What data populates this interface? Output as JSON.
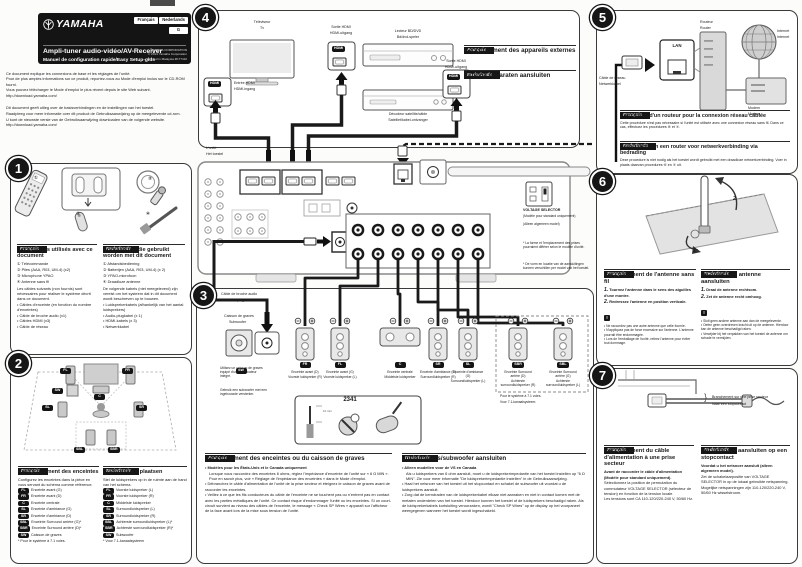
{
  "header": {
    "brand": "YAMAHA",
    "lang_fr": "Français",
    "lang_nl": "Nederlands",
    "g_label": "G",
    "title": "Ampli-tuner audio-vidéo/AV-Receiver",
    "subtitle": "Manuel de configuration rapide/Easy Setup-gids",
    "corp": "YAMAHA CORPORATION",
    "copyright": "© 2014 Yamaha Corporation",
    "printed": "Printed in Malaysia  ZK77110"
  },
  "intro": {
    "fr1": "Ce document explique les connexions de base et les réglages de l'unité.",
    "fr2": "Pour de plus amples informations sur ce produit, reportez-vous au Mode d'emploi inclus sur le CD-ROM fourni.",
    "fr3": "Vous pouvez télécharger le Mode d'emploi le plus récent depuis le site Web suivant.",
    "fr4": "http://download.yamaha.com/",
    "nl1": "Dit document geeft uitleg over de basisverbindingen en de instellingen van het toestel.",
    "nl2": "Raadpleeg voor meer informatie over dit product de Gebruiksaanwijzing op de meegeleverde cd-rom.",
    "nl3": "U kunt de nieuwste versie van de Gebruiksaanwijzing downloaden van de volgende website.",
    "nl4": "http://download.yamaha.com/"
  },
  "tag_fr": "Français",
  "tag_nl": "Nederlands",
  "step1": {
    "num": "1",
    "marks": [
      "①",
      "②",
      "③",
      "④"
    ],
    "fr": {
      "title": "Accessoires utilisés avec ce document",
      "items": [
        "① Télécommande",
        "② Piles (AAA, R03, UM-4) (x2)",
        "③ Microphone YPAO",
        "④ Antenne sans fil"
      ],
      "note": "Les câbles suivants (non fournis) sont nécessaires pour réaliser le système décrit dans ce document.",
      "bullets": [
        "• Câbles d'enceinte (en fonction du nombre d'enceintes)",
        "• Câble de broche audio (x1)",
        "• Câbles HDMI (x3)",
        "• Câble de réseau"
      ]
    },
    "nl": {
      "title": "Accessoires die gebruikt worden met dit document",
      "items": [
        "① Afstandsbediening",
        "② Batterijen (AAA, R03, UM-4) (x 2)",
        "③ YPAO-microfoon",
        "④ Draadloze antenne"
      ],
      "note": "De volgende kabels (niet meegeleverd) zijn vereist om het systeem dat in dit document wordt beschreven op te bouwen.",
      "bullets": [
        "• Luidsprekerkabels (afhankelijk van het aantal luidsprekers)",
        "• Audio-plugkabel (x 1)",
        "• HDMI-kabels (x 3)",
        "• Netwerkkabel"
      ]
    }
  },
  "step2": {
    "num": "2",
    "diagram": {
      "fl": "FL",
      "fr": "FR",
      "c": "C",
      "sw": "SW",
      "sl": "SL",
      "sr": "SR",
      "sbl": "SBL",
      "sbr": "SBR"
    },
    "fr": {
      "title": "Positionnement des enceintes",
      "intro": "Configurez les enceintes dans la pièce en vous servant du schéma comme référence.",
      "rows": [
        {
          "b": "FL",
          "t": "Enceinte avant (G)"
        },
        {
          "b": "FR",
          "t": "Enceinte avant (D)"
        },
        {
          "b": "C",
          "t": "Enceinte centrale"
        },
        {
          "b": "SL",
          "t": "Enceinte d'ambiance (G)"
        },
        {
          "b": "SR",
          "t": "Enceinte d'ambiance (D)"
        },
        {
          "b": "SBL",
          "t": "Enceinte Surround arrière (G)*"
        },
        {
          "b": "SBR",
          "t": "Enceinte Surround arrière (D)*"
        },
        {
          "b": "SW",
          "t": "Caisson de graves"
        }
      ],
      "footnote": "* Pour le système à 7.1 voies."
    },
    "nl": {
      "title": "Luidsprekers plaatsen",
      "intro": "Stel de luidsprekers op in de ruimte aan de hand van het schema.",
      "rows": [
        {
          "b": "FL",
          "t": "Voorste luidspreker (L)"
        },
        {
          "b": "FR",
          "t": "Voorste luidspreker (R)"
        },
        {
          "b": "C",
          "t": "Middelste luidspreker"
        },
        {
          "b": "SL",
          "t": "Surroundluidspreker (L)"
        },
        {
          "b": "SR",
          "t": "Surroundluidspreker (R)"
        },
        {
          "b": "SBL",
          "t": "Achterste surroundluidspreker (L)*"
        },
        {
          "b": "SBR",
          "t": "Achterste surroundluidspreker (R)*"
        },
        {
          "b": "SW",
          "t": "Subwoofer"
        }
      ],
      "footnote": "* Voor 7.1-kanaalsysteem"
    }
  },
  "step3": {
    "num": "3",
    "pin_cable_fr": "Câble de broche audio",
    "pin_cable_nl": "Audio-plugkabel",
    "sw_title_fr": "Caisson de graves",
    "sw_title_nl": "Subwoofer",
    "sw_badge": "SW",
    "sw_note_fr": "Utilisez un caisson de graves équipé d'un amplificateur intégré.",
    "sw_note_nl": "Gebruik een subwoofer met een ingebouwde versterker.",
    "speakers": [
      {
        "b": "FR",
        "fr": "Enceinte avant (D)",
        "nl": "Voorste luidspreker (R)"
      },
      {
        "b": "FL",
        "fr": "Enceinte avant (G)",
        "nl": "Voorste luidspreker (L)"
      },
      {
        "b": "C",
        "fr": "Enceinte centrale",
        "nl": "Middelste luidspreker"
      },
      {
        "b": "SR",
        "fr": "Enceinte d'ambiance (D)",
        "nl": "Surroundluidspreker (R)"
      },
      {
        "b": "SL",
        "fr": "Enceinte d'ambiance (G)",
        "nl": "Surroundluidspreker (L)"
      },
      {
        "b": "SBR",
        "fr": "Enceinte Surround arrière (D)",
        "nl": "Achterste surroundluidspreker (R)"
      },
      {
        "b": "SBL",
        "fr": "Enceinte Surround arrière (G)",
        "nl": "Achterste surroundluidspreker (L)"
      }
    ],
    "note71_fr": "Pour le système à 7.1 voies.",
    "note71_nl": "Voor 7.1-kanaalsysteem",
    "inset_num": "2341",
    "inset_mm": "10 mm",
    "fr": {
      "title": "Raccordement des enceintes ou du caisson de graves",
      "b1_head": "• Modèles pour les États-Unis et le Canada uniquement",
      "b1": "Lorsque vous raccordez des enceintes 6 ohms, réglez l'impédance d'enceinte de l'unité sur « 6 Ω MIN ». Pour en savoir plus, voir « Réglage de l'impédance des enceintes » dans le Mode d'emploi.",
      "b2": "• Débranchez le câble d'alimentation de l'unité de la prise secteur et éteignez le caisson de graves avant de raccorder les enceintes.",
      "b3": "• Veillez à ce que les fils conducteurs du câble de l'enceinte ne se touchent pas ou n'entrent pas en contact avec les parties métalliques de l'unité. Ce contact risque d'endommager l'unité ou les enceintes. Si un court-circuit survient au niveau des câbles de l'enceinte, le message « Check SP Wires » apparaît sur l'afficheur de la face avant lors de la mise sous tension de l'unité."
    },
    "nl": {
      "title": "Luidsprekers/subwoofer aansluiten",
      "b1_head": "• Alleen modellen voor de VS en Canada",
      "b1": "Als u luidsprekers van 6 ohm aansluit, moet u de luidsprekerimpedantie van het toestel instellen op \"6 Ω MIN\". Zie voor meer informatie \"De luidsprekerimpedantie instellen\" in de Gebruiksaanwijzing.",
      "b2": "• Haal het netsnoer van het toestel uit het stopcontact en schakel de subwoofer uit voordat u de luidsprekers aansluit.",
      "b3": "• Zorg dat de kerndraden van de luidsprekerkabel elkaar niet aanraken en niet in contact komen met de metalen onderdelen van het toestel. Hierdoor kunnen het toestel of de luidsprekers beschadigd raken. Als de luidsprekerkabels kortsluiting veroorzaken, wordt \"Check SP Wires\" op de display op het voorpaneel weergegeven wanneer het toestel wordt ingeschakeld."
    }
  },
  "step4": {
    "num": "4",
    "tv_fr": "Téléviseur",
    "tv_nl": "Tv",
    "in_fr": "Entrée HDMI",
    "in_nl": "HDMI-ingang",
    "out_fr": "Sortie HDMI",
    "out_nl": "HDMI-uitgang",
    "bd_fr": "Lecteur BD/DVD",
    "bd_nl": "Bd/dvd-speler",
    "sat_fr": "Décodeur satellite/câble",
    "sat_nl": "Satelliet/kabel-ontvanger",
    "hdmi": "HDMI",
    "fr_title": "Raccordement des appareils externes",
    "nl_title": "Externe apparaten aansluiten"
  },
  "unit": {
    "label_fr": "L'unité",
    "label_nl": "Het toestel",
    "vs": "VOLTAGE SELECTOR",
    "vs_fr": "(Modèle pour standard uniquement)",
    "vs_nl": "(Alleen algemeen model)",
    "fn_fr": "* La forme et l'emplacement des prises pourraient différer selon le modèle d'unité.",
    "fn_nl": "* De vorm en locatie van de aansluitingen kunnen verschillen per model van het toestel."
  },
  "step5": {
    "num": "5",
    "router_fr": "Routeur",
    "router_nl": "Router",
    "inet_fr": "Internet",
    "inet_nl": "Internet",
    "lan": "LAN",
    "cable_fr": "Câble de réseau",
    "cable_nl": "Netwerkkabel",
    "modem_fr": "Modem",
    "modem_nl": "Modem",
    "fr_title": "Connexion d'un routeur pour la connexion réseau câblée",
    "fr_body": "Cette procédure n'est pas nécessaire si l'unité est utilisée avec une connexion réseau sans fil. Dans ce cas, effectuez les procédures ⑥ et ⑦.",
    "nl_title": "Aansluiten van een router voor netwerkverbinding via bedrading",
    "nl_body": "Deze procedure is niet nodig als het toestel wordt gebruikt met een draadloze netwerkverbinding. Voer in plaats daarvan procedures ⑥ en ⑦ uit."
  },
  "step6": {
    "num": "6",
    "arrow1": "1",
    "arrow2": "2",
    "fr": {
      "title": "Raccordement de l'antenne sans fil",
      "s1": "1.",
      "s1t": "Tournez l'antenne dans le sens des aiguilles d'une montre.",
      "s2": "2.",
      "s2t": "Redressez l'antenne en position verticale.",
      "warn": "!",
      "bullets": [
        "• Ne raccordez pas une autre antenne que celle fournie.",
        "• N'appliquez pas de force excessive sur l'antenne. L'antenne pourrait être endommagée.",
        "• Lors de l'emballage de l'unité, retirez l'antenne pour éviter tout dommage."
      ]
    },
    "nl": {
      "title": "De draadloze antenne aansluiten",
      "s1": "1.",
      "s1t": "Draai de antenne rechtsom.",
      "s2": "2.",
      "s2t": "Zet de antenne recht omhoog.",
      "warn": "!",
      "bullets": [
        "• Sluit geen andere antenne aan dan de meegeleverde.",
        "• Oefen geen overdreven kracht uit op de antenne. Hierdoor kan de antenne beschadigd raken.",
        "• Verwijder bij het verpakken van het toestel de antenne om schade te vermijden."
      ]
    }
  },
  "step7": {
    "num": "7",
    "brace": "}",
    "outlet_fr": "Branchement sur une prise secteur",
    "outlet_nl": "Naar een stopcontact",
    "fr": {
      "title": "Raccordement du câble d'alimentation à une prise secteur",
      "bold": "Avant de raccorder le câble d'alimentation (Modèle pour standard uniquement).",
      "body1": "Sélectionnez la position de permutation du commutateur VOLTAGE SELECTOR (sélecteur de tension) en fonction de la tension locale.",
      "body2": "Les tensions sont CA 110-120/220-240 V, 50/60 Hz."
    },
    "nl": {
      "title": "Het netsnoer aansluiten op een stopcontact",
      "bold": "Voordat u het netsnoer aansluit (alleen algemeen model).",
      "body1": "Zet de schakelaarpositie van VOLTAGE SELECTOR in op de lokaal gebruikte netspanning.",
      "body2": "Mogelijke netspanningen zijn 110-120/220-240 V, 50/60 Hz wisselstroom."
    }
  }
}
